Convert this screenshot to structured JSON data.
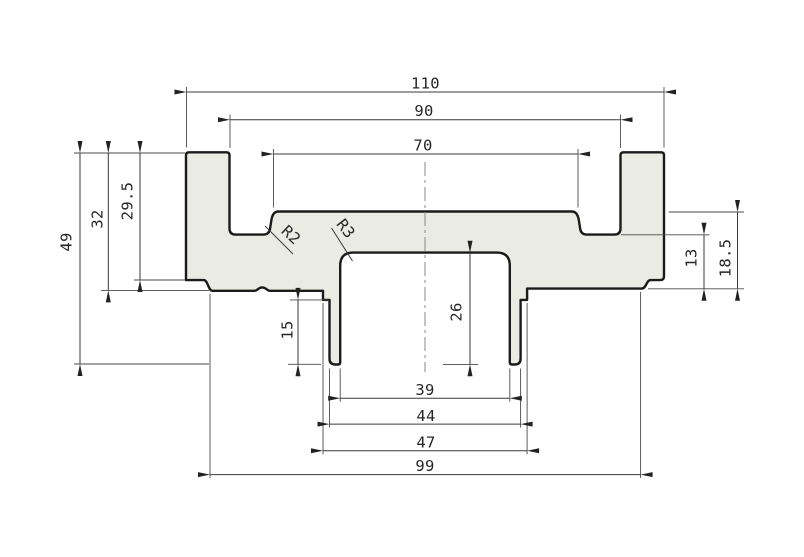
{
  "dimensions": {
    "top": [
      "110",
      "90",
      "70"
    ],
    "left": [
      "49",
      "32",
      "29.5"
    ],
    "right": [
      "13",
      "18.5"
    ],
    "bottom": [
      "39",
      "44",
      "47",
      "99"
    ],
    "inner": [
      "15",
      "26"
    ],
    "radii": [
      "R2",
      "R3"
    ]
  },
  "colors": {
    "background": "#ffffff",
    "material_fill": "#eaece3",
    "profile_outline": "#1b1b1b",
    "dimension_lines": "#3a3a3a",
    "centerline": "#8a8a8a",
    "text": "#262626"
  }
}
